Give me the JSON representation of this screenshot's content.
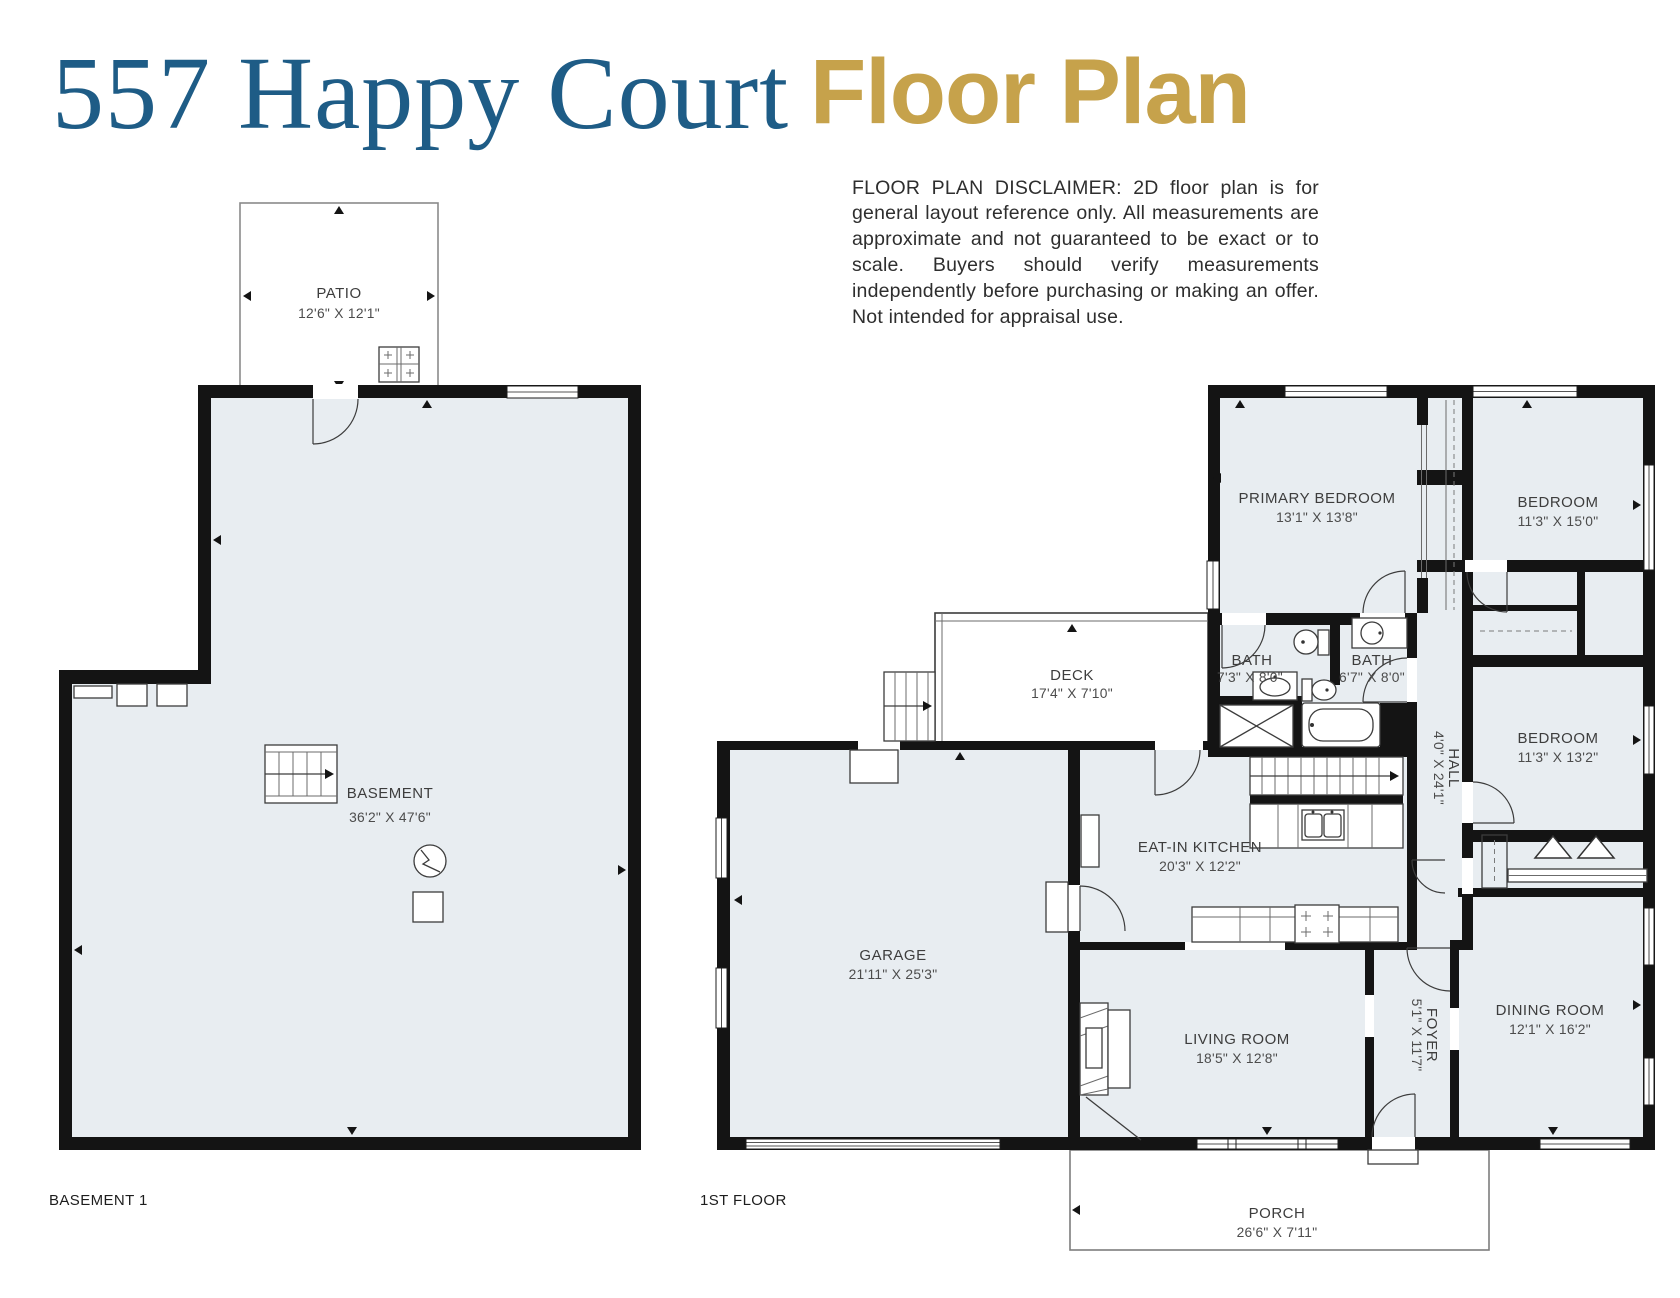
{
  "header": {
    "address": "557 Happy Court",
    "title": "Floor Plan",
    "disclaimer": "FLOOR PLAN DISCLAIMER: 2D floor plan is for general layout reference only. All measurements are approximate and not guaranteed to be exact or to scale. Buyers should verify measurements independently before purchasing or making an offer. Not intended for appraisal use."
  },
  "colors": {
    "accent_blue": "#1e5c86",
    "accent_gold": "#c6a24b",
    "room_fill": "#e8edf1",
    "wall": "#141414"
  },
  "plans": {
    "basement": {
      "label": "BASEMENT 1",
      "rooms": {
        "patio": {
          "name": "PATIO",
          "dims": "12'6\" X 12'1\""
        },
        "basement": {
          "name": "BASEMENT",
          "dims": "36'2\" X 47'6\""
        }
      }
    },
    "first": {
      "label": "1ST FLOOR",
      "rooms": {
        "primary_bedroom": {
          "name": "PRIMARY BEDROOM",
          "dims": "13'1\" X 13'8\""
        },
        "bedroom_top": {
          "name": "BEDROOM",
          "dims": "11'3\" X 15'0\""
        },
        "bedroom_mid": {
          "name": "BEDROOM",
          "dims": "11'3\" X 13'2\""
        },
        "bath_left": {
          "name": "BATH",
          "dims": "7'3\" X 8'0\""
        },
        "bath_right": {
          "name": "BATH",
          "dims": "6'7\" X 8'0\""
        },
        "hall": {
          "name": "HALL",
          "dims": "4'0\" X 24'1\""
        },
        "deck": {
          "name": "DECK",
          "dims": "17'4\" X 7'10\""
        },
        "kitchen": {
          "name": "EAT-IN KITCHEN",
          "dims": "20'3\" X 12'2\""
        },
        "garage": {
          "name": "GARAGE",
          "dims": "21'11\" X 25'3\""
        },
        "living": {
          "name": "LIVING ROOM",
          "dims": "18'5\" X 12'8\""
        },
        "foyer": {
          "name": "FOYER",
          "dims": "5'1\" X 11'7\""
        },
        "dining": {
          "name": "DINING ROOM",
          "dims": "12'1\" X 16'2\""
        },
        "porch": {
          "name": "PORCH",
          "dims": "26'6\" X 7'11\""
        }
      }
    }
  }
}
